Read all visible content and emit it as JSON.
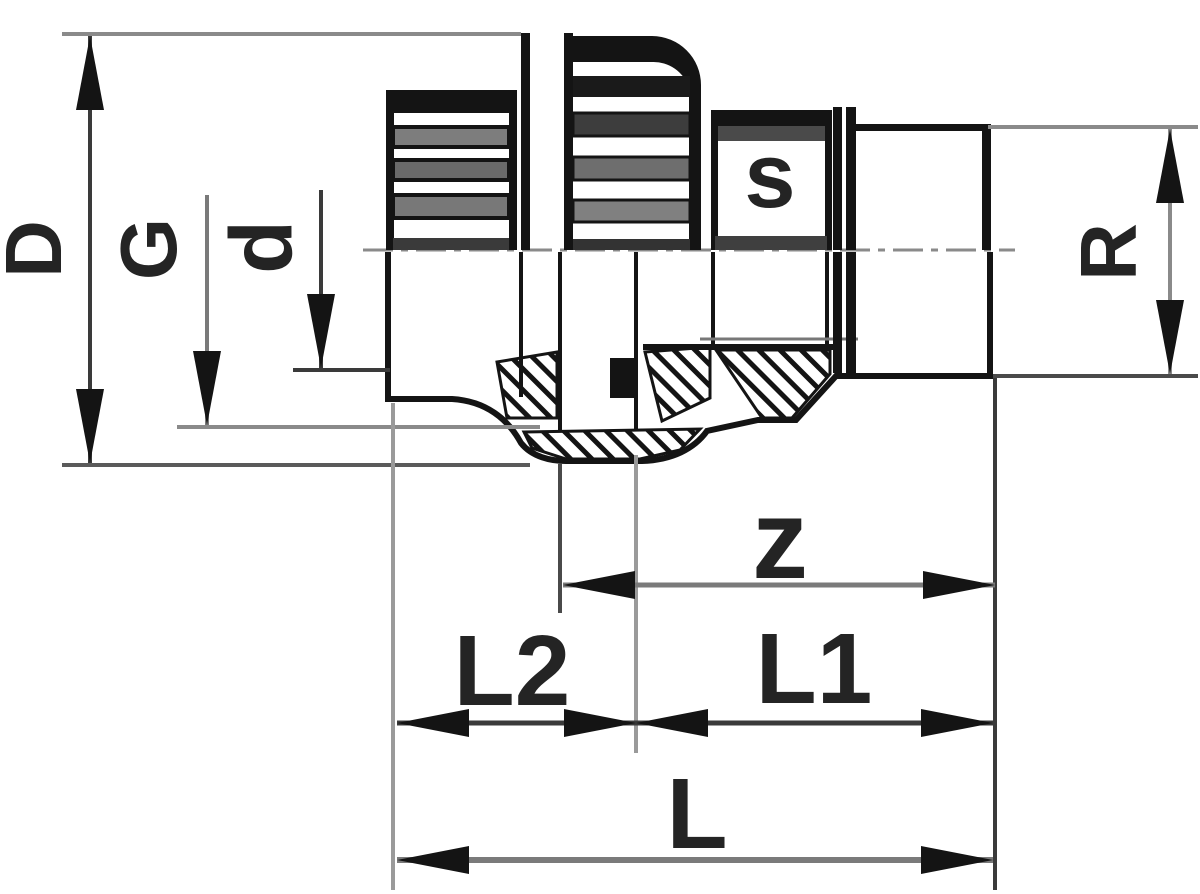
{
  "drawing": {
    "background": "#ffffff",
    "outline_color": "#141414",
    "dimension_line_color": "#7a7a7a",
    "label_color": "#242424",
    "dimensions": {
      "outer_diameter": "D",
      "union_thread": "G",
      "socket_bore": "d",
      "spanner_size": "s",
      "male_thread": "R",
      "z_length": "z",
      "l2_length": "L2",
      "l1_length": "L1",
      "overall_length": "L"
    }
  }
}
